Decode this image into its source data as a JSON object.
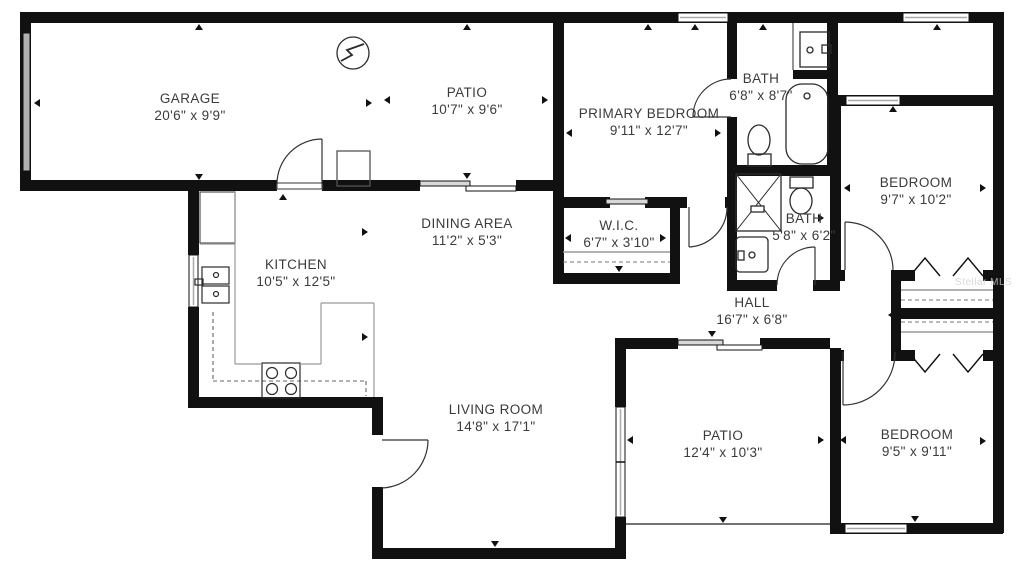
{
  "plan": {
    "title": "Floor plan",
    "watermark": "Stellar MLS",
    "rooms": {
      "garage": {
        "name": "GARAGE",
        "dims": "20'6\" x 9'9\""
      },
      "patio_top": {
        "name": "PATIO",
        "dims": "10'7\" x 9'6\""
      },
      "primary_bedroom": {
        "name": "PRIMARY BEDROOM",
        "dims": "9'11\" x 12'7\""
      },
      "bath_top": {
        "name": "BATH",
        "dims": "6'8\" x 8'7\""
      },
      "bedroom_top": {
        "name": "BEDROOM",
        "dims": "9'7\" x 10'2\""
      },
      "dining": {
        "name": "DINING AREA",
        "dims": "11'2\" x 5'3\""
      },
      "wic": {
        "name": "W.I.C.",
        "dims": "6'7\" x 3'10\""
      },
      "kitchen": {
        "name": "KITCHEN",
        "dims": "10'5\" x 12'5\""
      },
      "bath_mid": {
        "name": "BATH",
        "dims": "5'8\" x 6'2\""
      },
      "hall": {
        "name": "HALL",
        "dims": "16'7\" x 6'8\""
      },
      "living": {
        "name": "LIVING ROOM",
        "dims": "14'8\" x 17'1\""
      },
      "patio_bottom": {
        "name": "PATIO",
        "dims": "12'4\" x 10'3\""
      },
      "bedroom_bottom": {
        "name": "BEDROOM",
        "dims": "9'5\" x 9'11\""
      }
    },
    "colors": {
      "wall": "#111111",
      "label": "#3b3b3b",
      "glass": "#b9b9b9",
      "fixture": "#2b2b2b",
      "watermark": "#cfcfcf"
    }
  }
}
